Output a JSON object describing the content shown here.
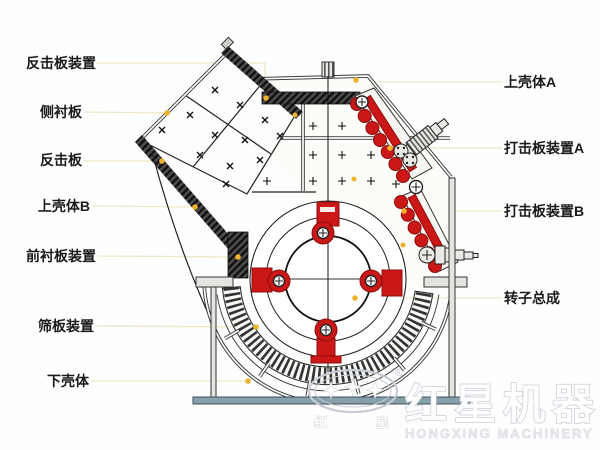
{
  "labels_left": [
    {
      "text": "反击板装置"
    },
    {
      "text": "侧衬板"
    },
    {
      "text": "反击板"
    },
    {
      "text": "上壳体B"
    },
    {
      "text": "前衬板装置"
    },
    {
      "text": "筛板装置"
    },
    {
      "text": "下壳体"
    }
  ],
  "labels_right": [
    {
      "text": "上壳体A"
    },
    {
      "text": "打击板装置A"
    },
    {
      "text": "打击板装置B"
    },
    {
      "text": "转子总成"
    }
  ],
  "watermark": {
    "brand_cn": "红星机器",
    "brand_en": "HONGXING MACHINERY",
    "registered": "®",
    "stamp_left": "红",
    "stamp_right": "星"
  },
  "colors": {
    "red": "#cc1717",
    "leader_line": "#efe8c4",
    "leader_dot": "#f0b42a",
    "base_bar": "#87a1ab"
  }
}
